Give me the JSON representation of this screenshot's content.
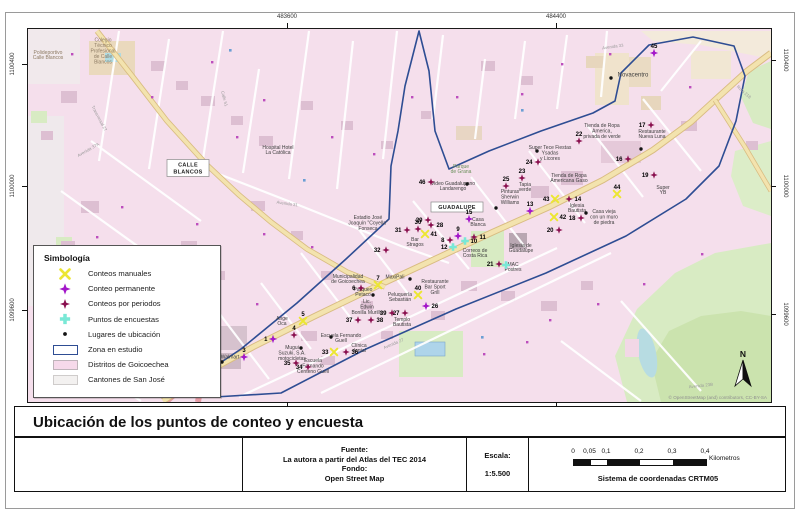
{
  "colors": {
    "manual": "#ece632",
    "permanente": "#a316c9",
    "periodos": "#8a104f",
    "encuesta": "#79e8d6",
    "ubicacion": "#141414",
    "zona": "#2e4d93",
    "distrito": "#f6d9ea",
    "canton": "#f3f1f0"
  },
  "frame": {
    "title": "Ubicación de los puntos de conteo y encuesta",
    "source_lines": [
      "Fuente:",
      "La autora a partir del Atlas del TEC 2014",
      "Fondo:",
      "Open Street Map"
    ],
    "scale_label": "Escala:",
    "scale_value": "1:5.500",
    "crs": "Sistema de coordenadas CRTM05",
    "scalebar": {
      "labels": [
        "0",
        "0,05",
        "0,1",
        "0,2",
        "0,3",
        "0,4"
      ],
      "unit": "Kilometros"
    },
    "attribution": "© OpenStreetMap (and) contributors, CC-BY-SA",
    "north_label": "N"
  },
  "grid": {
    "top": [
      {
        "t": "483600",
        "x": 287
      },
      {
        "t": "484400",
        "x": 556
      }
    ],
    "bottom_ticks": [
      287,
      556
    ],
    "left": [
      {
        "t": "1100400",
        "y": 64
      },
      {
        "t": "1100000",
        "y": 186
      },
      {
        "t": "1099600",
        "y": 310
      }
    ],
    "right": [
      {
        "t": "1100400",
        "y": 60
      },
      {
        "t": "1100000",
        "y": 186
      },
      {
        "t": "1099600",
        "y": 314
      }
    ]
  },
  "legend": {
    "title": "Simbología",
    "items": [
      {
        "label": "Conteos manuales",
        "type": "manual"
      },
      {
        "label": "Conteo permanente",
        "type": "permanente"
      },
      {
        "label": "Conteos por periodos",
        "type": "periodos"
      },
      {
        "label": "Puntos de encuestas",
        "type": "encuesta"
      },
      {
        "label": "Lugares de ubicación",
        "type": "ubicacion"
      },
      {
        "label": "Zona en estudio",
        "type": "zona"
      },
      {
        "label": "Distritos de Goicoechea",
        "type": "distrito"
      },
      {
        "label": "Cantones de San José",
        "type": "canton"
      }
    ]
  },
  "map": {
    "zone": [
      [
        418,
        30
      ],
      [
        404,
        85
      ],
      [
        397,
        130
      ],
      [
        390,
        165
      ],
      [
        388,
        218
      ],
      [
        345,
        258
      ],
      [
        296,
        302
      ],
      [
        240,
        348
      ],
      [
        204,
        372
      ],
      [
        214,
        396
      ],
      [
        280,
        392
      ],
      [
        365,
        348
      ],
      [
        455,
        308
      ],
      [
        545,
        272
      ],
      [
        625,
        235
      ],
      [
        685,
        198
      ],
      [
        718,
        165
      ],
      [
        735,
        120
      ],
      [
        744,
        75
      ],
      [
        733,
        45
      ],
      [
        692,
        36
      ],
      [
        648,
        44
      ],
      [
        620,
        72
      ],
      [
        614,
        100
      ],
      [
        592,
        112
      ],
      [
        540,
        130
      ],
      [
        488,
        150
      ],
      [
        448,
        168
      ],
      [
        434,
        130
      ],
      [
        428,
        70
      ]
    ],
    "boxes": [
      {
        "t": "GUADALUPE",
        "x": 456,
        "y": 206,
        "w": 52,
        "h": 10,
        "lines": 1
      },
      {
        "t": "CALLE BLANCOS",
        "x": 187,
        "y": 167,
        "w": 42,
        "h": 17,
        "lines": 2
      }
    ],
    "labels": [
      {
        "t": "Colegio\nTécnico\nProfesional\nde Calle\nBlancos",
        "x": 102,
        "y": 50,
        "c": "#8d7b63"
      },
      {
        "t": "Polideportivo\nCalle Blancos",
        "x": 47,
        "y": 54,
        "c": "#8d7b63"
      },
      {
        "t": "Hospital Hotel\nLa Católica",
        "x": 277,
        "y": 149
      },
      {
        "t": "Estadio José\nJoaquín \"Coyella\"\nFonseca",
        "x": 367,
        "y": 222
      },
      {
        "t": "Parque\nde Grana",
        "x": 460,
        "y": 168,
        "c": "#6a8f5a"
      },
      {
        "t": "Video Guadalupano\nLandarengo",
        "x": 452,
        "y": 185
      },
      {
        "t": "Casa\nBlanca",
        "x": 477,
        "y": 221
      },
      {
        "t": "Correos de\nCosta Rica",
        "x": 474,
        "y": 252
      },
      {
        "t": "Iglesia de\nGuadalupe",
        "x": 520,
        "y": 247
      },
      {
        "t": "MAC\nPostres",
        "x": 512,
        "y": 266
      },
      {
        "t": "Pinturas\nSherwin\nWilliams",
        "x": 509,
        "y": 196
      },
      {
        "t": "Tapia\nverde",
        "x": 524,
        "y": 186
      },
      {
        "t": "Iglesia\nBautista",
        "x": 576,
        "y": 207
      },
      {
        "t": "Super Tece Fiestas\nYsadas\ny Licores",
        "x": 549,
        "y": 152
      },
      {
        "t": "Tienda de Ropa\nAmericana Gaso",
        "x": 568,
        "y": 177
      },
      {
        "t": "Tienda de Ropa\nAmerica,\nprivada de verde",
        "x": 601,
        "y": 130
      },
      {
        "t": "Restaurante\nNueva Luna",
        "x": 651,
        "y": 133
      },
      {
        "t": "Casa vieja\ncon un muro\nde piedra",
        "x": 603,
        "y": 216
      },
      {
        "t": "Super\nYB",
        "x": 662,
        "y": 189
      },
      {
        "t": "Novacentro",
        "x": 632,
        "y": 74,
        "s": 6
      },
      {
        "t": "Municipalidad\nde Goicoechea",
        "x": 347,
        "y": 278
      },
      {
        "t": "MaxiPali",
        "x": 394,
        "y": 276
      },
      {
        "t": "Restaurante\nBar Sport\nGrill",
        "x": 434,
        "y": 286
      },
      {
        "t": "Peluquería\nSebastián",
        "x": 399,
        "y": 296
      },
      {
        "t": "Lic.\nEdwin\nBonilla Murillo",
        "x": 366,
        "y": 306
      },
      {
        "t": "Templo\nBautista",
        "x": 401,
        "y": 321
      },
      {
        "t": "Parqueo\nPetaco",
        "x": 362,
        "y": 291
      },
      {
        "t": "Escuela Fernando\nGuell",
        "x": 340,
        "y": 337
      },
      {
        "t": "Clínica\ndental",
        "x": 358,
        "y": 347
      },
      {
        "t": "Escuela\nFernando\nCenteno Guell",
        "x": 312,
        "y": 365
      },
      {
        "t": "Walmart",
        "x": 229,
        "y": 356
      },
      {
        "t": "Mugui\nSuzuki, S.A.\nmotocicletas",
        "x": 291,
        "y": 352
      },
      {
        "t": "Ange\nOca",
        "x": 281,
        "y": 320
      },
      {
        "t": "Bar\nStragos",
        "x": 414,
        "y": 241
      }
    ],
    "streets": [
      {
        "t": "Avenida 37A",
        "x": 88,
        "y": 150,
        "r": -30
      },
      {
        "t": "Transversal 27",
        "x": 97,
        "y": 118,
        "r": 62
      },
      {
        "t": "Avenida 31",
        "x": 286,
        "y": 204,
        "r": 8
      },
      {
        "t": "Avenida 33",
        "x": 612,
        "y": 47,
        "r": -8
      },
      {
        "t": "Avenida 27",
        "x": 393,
        "y": 344,
        "r": -23
      },
      {
        "t": "Ruta 218",
        "x": 742,
        "y": 92,
        "r": 42
      },
      {
        "t": "Avenida 23B",
        "x": 700,
        "y": 386,
        "r": -6
      },
      {
        "t": "Calle 51",
        "x": 222,
        "y": 98,
        "r": 75
      }
    ],
    "markers": [
      {
        "n": "1",
        "t": "permanente",
        "x": 272,
        "y": 338,
        "p": "l"
      },
      {
        "n": "3",
        "t": "permanente",
        "x": 243,
        "y": 356,
        "p": "t"
      },
      {
        "n": "4",
        "t": "periodos",
        "x": 293,
        "y": 334,
        "p": "t"
      },
      {
        "n": "5",
        "t": "manual",
        "x": 302,
        "y": 320,
        "p": "t"
      },
      {
        "n": "6",
        "t": "periodos",
        "x": 360,
        "y": 287,
        "p": "l"
      },
      {
        "n": "7",
        "t": "manual",
        "x": 377,
        "y": 284,
        "p": "t"
      },
      {
        "n": "8",
        "t": "periodos",
        "x": 449,
        "y": 239,
        "p": "l"
      },
      {
        "n": "9",
        "t": "permanente",
        "x": 457,
        "y": 235,
        "p": "t"
      },
      {
        "n": "10",
        "t": "encuesta",
        "x": 464,
        "y": 240,
        "p": "r"
      },
      {
        "n": "11",
        "t": "periodos",
        "x": 473,
        "y": 236,
        "p": "r"
      },
      {
        "n": "12",
        "t": "encuesta",
        "x": 452,
        "y": 246,
        "p": "l"
      },
      {
        "n": "13",
        "t": "permanente",
        "x": 529,
        "y": 210,
        "p": "t"
      },
      {
        "n": "14",
        "t": "periodos",
        "x": 568,
        "y": 198,
        "p": "r"
      },
      {
        "n": "15",
        "t": "permanente",
        "x": 468,
        "y": 218,
        "p": "t"
      },
      {
        "n": "16",
        "t": "periodos",
        "x": 627,
        "y": 158,
        "p": "l"
      },
      {
        "n": "17",
        "t": "periodos",
        "x": 650,
        "y": 124,
        "p": "l"
      },
      {
        "n": "18",
        "t": "periodos",
        "x": 580,
        "y": 217,
        "p": "l"
      },
      {
        "n": "19",
        "t": "periodos",
        "x": 653,
        "y": 174,
        "p": "l"
      },
      {
        "n": "20",
        "t": "periodos",
        "x": 558,
        "y": 229,
        "p": "l"
      },
      {
        "n": "21",
        "t": "periodos",
        "x": 498,
        "y": 263,
        "p": "l"
      },
      {
        "n": "22",
        "t": "periodos",
        "x": 578,
        "y": 140,
        "p": "t"
      },
      {
        "n": "23",
        "t": "periodos",
        "x": 521,
        "y": 177,
        "p": "t"
      },
      {
        "n": "24",
        "t": "periodos",
        "x": 537,
        "y": 161,
        "p": "l"
      },
      {
        "n": "25",
        "t": "periodos",
        "x": 505,
        "y": 185,
        "p": "t"
      },
      {
        "n": "26",
        "t": "permanente",
        "x": 425,
        "y": 305,
        "p": "r"
      },
      {
        "n": "27",
        "t": "periodos",
        "x": 404,
        "y": 312,
        "p": "l"
      },
      {
        "n": "28",
        "t": "periodos",
        "x": 430,
        "y": 224,
        "p": "r"
      },
      {
        "n": "29",
        "t": "periodos",
        "x": 427,
        "y": 219,
        "p": "l"
      },
      {
        "n": "30",
        "t": "periodos",
        "x": 417,
        "y": 228,
        "p": "t"
      },
      {
        "n": "31",
        "t": "periodos",
        "x": 406,
        "y": 229,
        "p": "l"
      },
      {
        "n": "32",
        "t": "periodos",
        "x": 385,
        "y": 249,
        "p": "l"
      },
      {
        "n": "33",
        "t": "manual",
        "x": 333,
        "y": 351,
        "p": "l"
      },
      {
        "n": "34",
        "t": "periodos",
        "x": 307,
        "y": 366,
        "p": "l"
      },
      {
        "n": "35",
        "t": "periodos",
        "x": 295,
        "y": 362,
        "p": "l"
      },
      {
        "n": "36",
        "t": "periodos",
        "x": 345,
        "y": 351,
        "p": "r"
      },
      {
        "n": "37",
        "t": "periodos",
        "x": 357,
        "y": 319,
        "p": "l"
      },
      {
        "n": "38",
        "t": "periodos",
        "x": 370,
        "y": 319,
        "p": "r"
      },
      {
        "n": "39",
        "t": "periodos",
        "x": 391,
        "y": 312,
        "p": "l"
      },
      {
        "n": "40",
        "t": "manual",
        "x": 417,
        "y": 294,
        "p": "t"
      },
      {
        "n": "41",
        "t": "manual",
        "x": 424,
        "y": 233,
        "p": "r"
      },
      {
        "n": "42",
        "t": "manual",
        "x": 553,
        "y": 216,
        "p": "r"
      },
      {
        "n": "43",
        "t": "manual",
        "x": 554,
        "y": 198,
        "p": "l"
      },
      {
        "n": "44",
        "t": "manual",
        "x": 616,
        "y": 193,
        "p": "t"
      },
      {
        "n": "45",
        "t": "permanente",
        "x": 653,
        "y": 52,
        "p": "t"
      },
      {
        "n": "46",
        "t": "periodos",
        "x": 430,
        "y": 181,
        "p": "l"
      },
      {
        "t": "encuesta",
        "x": 505,
        "y": 264
      },
      {
        "t": "ubicacion",
        "x": 221,
        "y": 361
      },
      {
        "t": "ubicacion",
        "x": 610,
        "y": 77
      },
      {
        "t": "ubicacion",
        "x": 409,
        "y": 278
      },
      {
        "t": "ubicacion",
        "x": 466,
        "y": 183
      },
      {
        "t": "ubicacion",
        "x": 640,
        "y": 148
      },
      {
        "t": "ubicacion",
        "x": 585,
        "y": 212
      },
      {
        "t": "ubicacion",
        "x": 536,
        "y": 150
      },
      {
        "t": "ubicacion",
        "x": 300,
        "y": 347
      },
      {
        "t": "ubicacion",
        "x": 330,
        "y": 336
      },
      {
        "t": "ubicacion",
        "x": 495,
        "y": 207
      },
      {
        "t": "ubicacion",
        "x": 372,
        "y": 294
      }
    ]
  }
}
